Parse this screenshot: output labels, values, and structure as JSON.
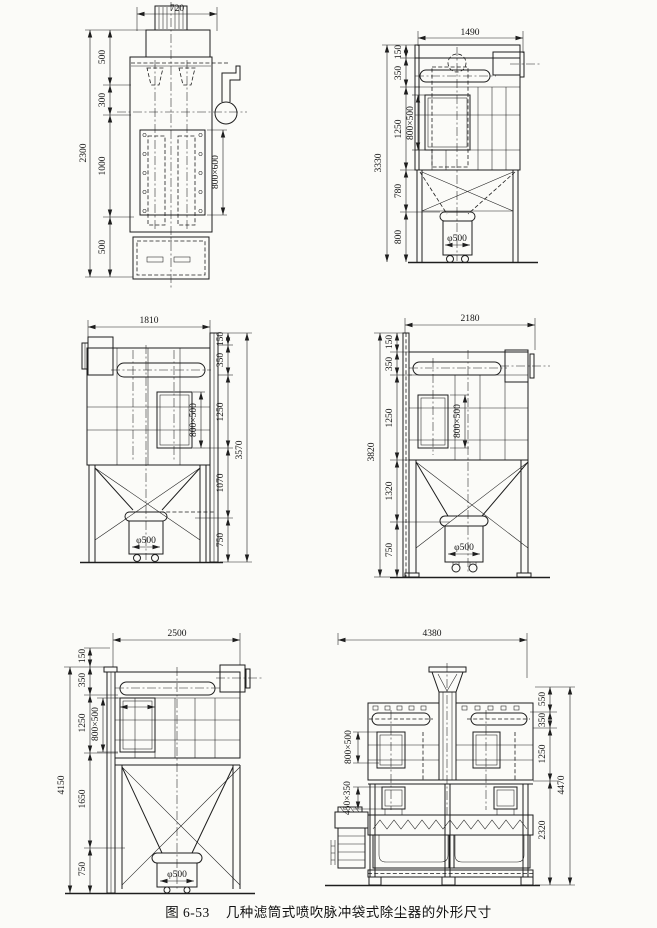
{
  "caption": {
    "fig_no": "图 6-53",
    "title": "几种滤筒式喷吹脉冲袋式除尘器的外形尺寸"
  },
  "drawings": {
    "d1": {
      "top_width": "720",
      "overall": "2300",
      "segs": [
        "500",
        "300",
        "1000",
        "500"
      ],
      "door": "800×600"
    },
    "d2": {
      "top_width": "1490",
      "overall": "3330",
      "segs": [
        "150",
        "350",
        "1250",
        "780",
        "800"
      ],
      "door": "800×500",
      "cart": "φ500"
    },
    "d3": {
      "top_width": "1810",
      "overall": "3570",
      "segs": [
        "150",
        "350",
        "1250",
        "1070",
        "750"
      ],
      "door": "800×500",
      "cart": "φ500"
    },
    "d4": {
      "top_width": "2180",
      "overall": "3820",
      "segs": [
        "150",
        "350",
        "1250",
        "1320",
        "750"
      ],
      "door": "800×500",
      "cart": "φ500"
    },
    "d5": {
      "top_width": "2500",
      "overall": "4150",
      "segs": [
        "150",
        "350",
        "1250",
        "1650",
        "750"
      ],
      "door": "800×500",
      "cart": "φ500"
    },
    "d6": {
      "top_width": "4380",
      "overall": "4470",
      "segs": [
        "550",
        "350",
        "1250",
        "2320"
      ],
      "door_upper": "800×500",
      "door_lower": "450×350"
    }
  }
}
